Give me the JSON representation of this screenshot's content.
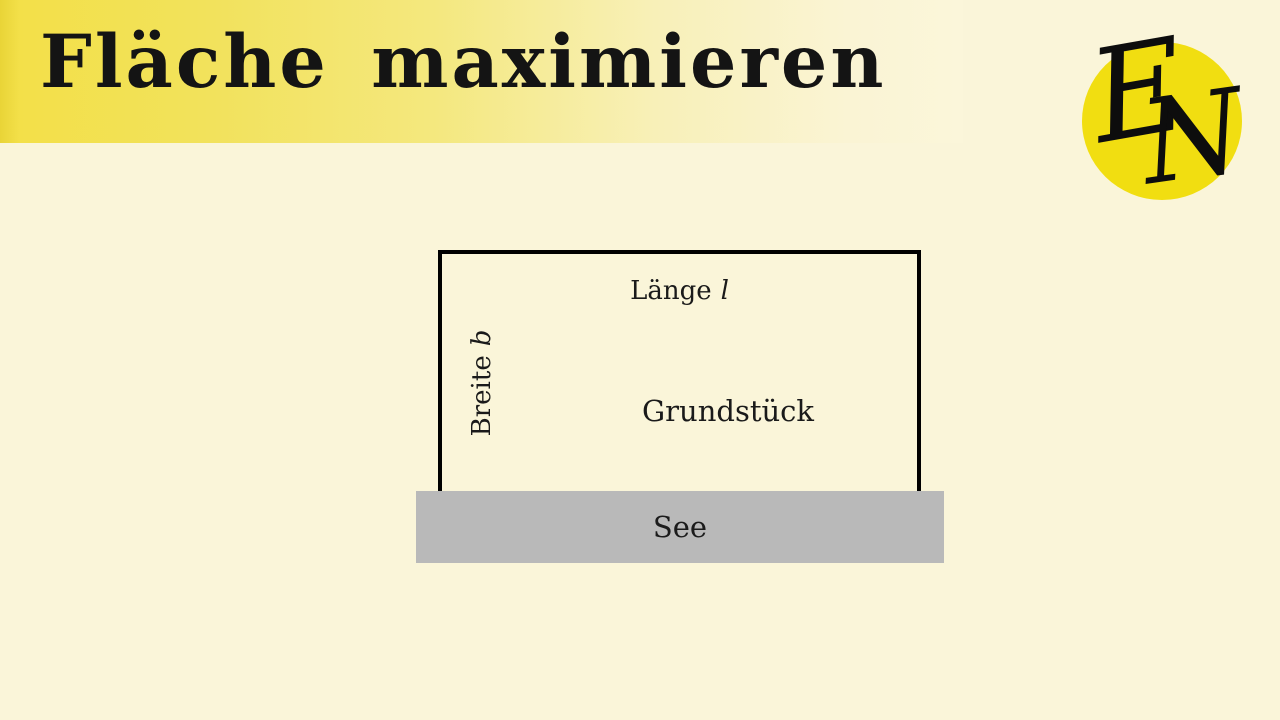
{
  "slide": {
    "background_color": "#faf5d9",
    "banner": {
      "title": "Fläche maximieren",
      "gradient_start": "#f3e049",
      "gradient_end": "#fbf6da"
    },
    "logo": {
      "monogram_first": "E",
      "monogram_second": "N",
      "circle_color": "#f1de11"
    },
    "diagram": {
      "length_label": "Länge",
      "length_symbol": "l",
      "width_label": "Breite",
      "width_symbol": "b",
      "area_label": "Grundstück",
      "lake_label": "See",
      "lake_color": "#b9b9b9",
      "rect_border_color": "#000000"
    }
  }
}
